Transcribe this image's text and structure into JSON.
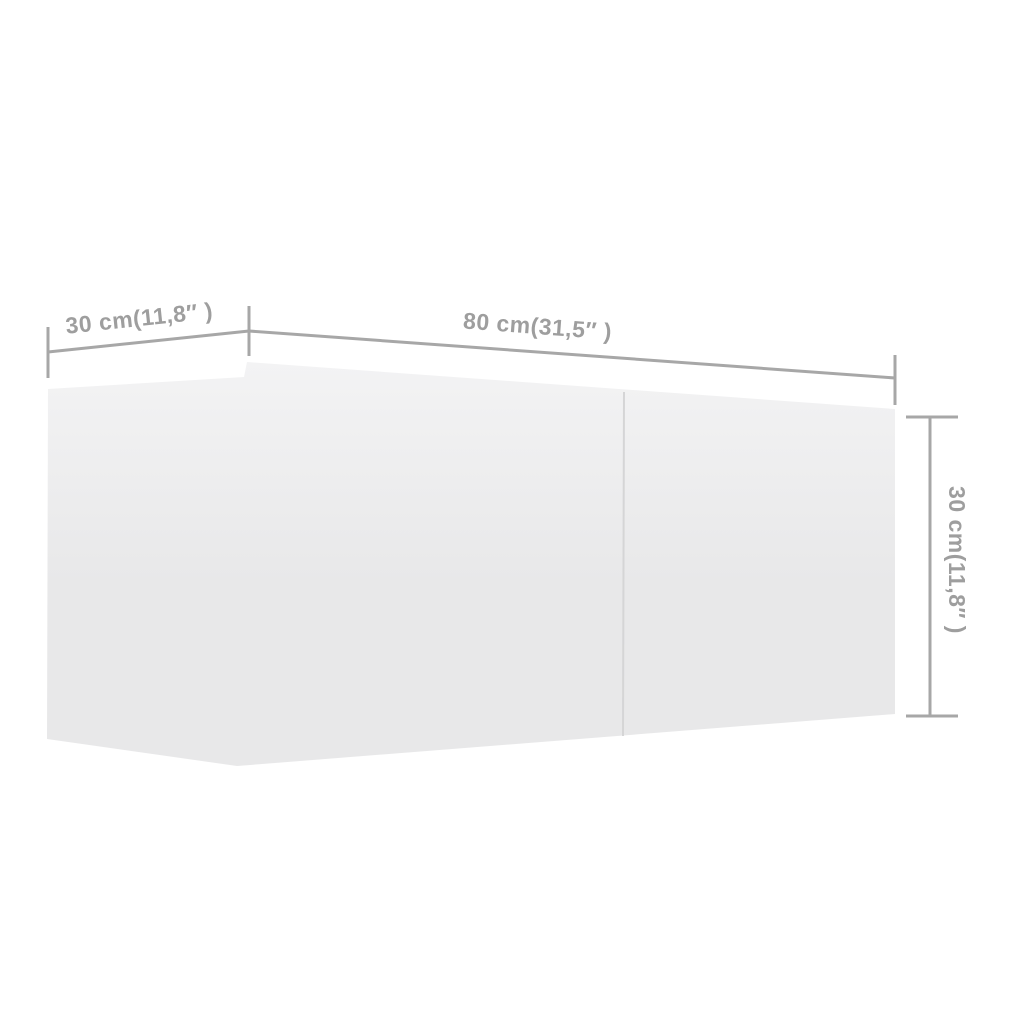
{
  "diagram": {
    "description": "Product dimension diagram of a white wall-mounted TV cabinet with two front panels, shown in perspective on a white background",
    "labels": {
      "depth": "30 cm(11,8″ )",
      "width": "80 cm(31,5″ )",
      "height": "30 cm(11,8″ )"
    },
    "colors": {
      "page_bg": "#ffffff",
      "dimension_line": "#a7a7a7",
      "label_text": "#9e9e9e",
      "cabinet_fill_top": "#f3f3f4",
      "cabinet_fill_bottom": "#e8e8e9",
      "divider_line": "#d5d5d6"
    }
  }
}
